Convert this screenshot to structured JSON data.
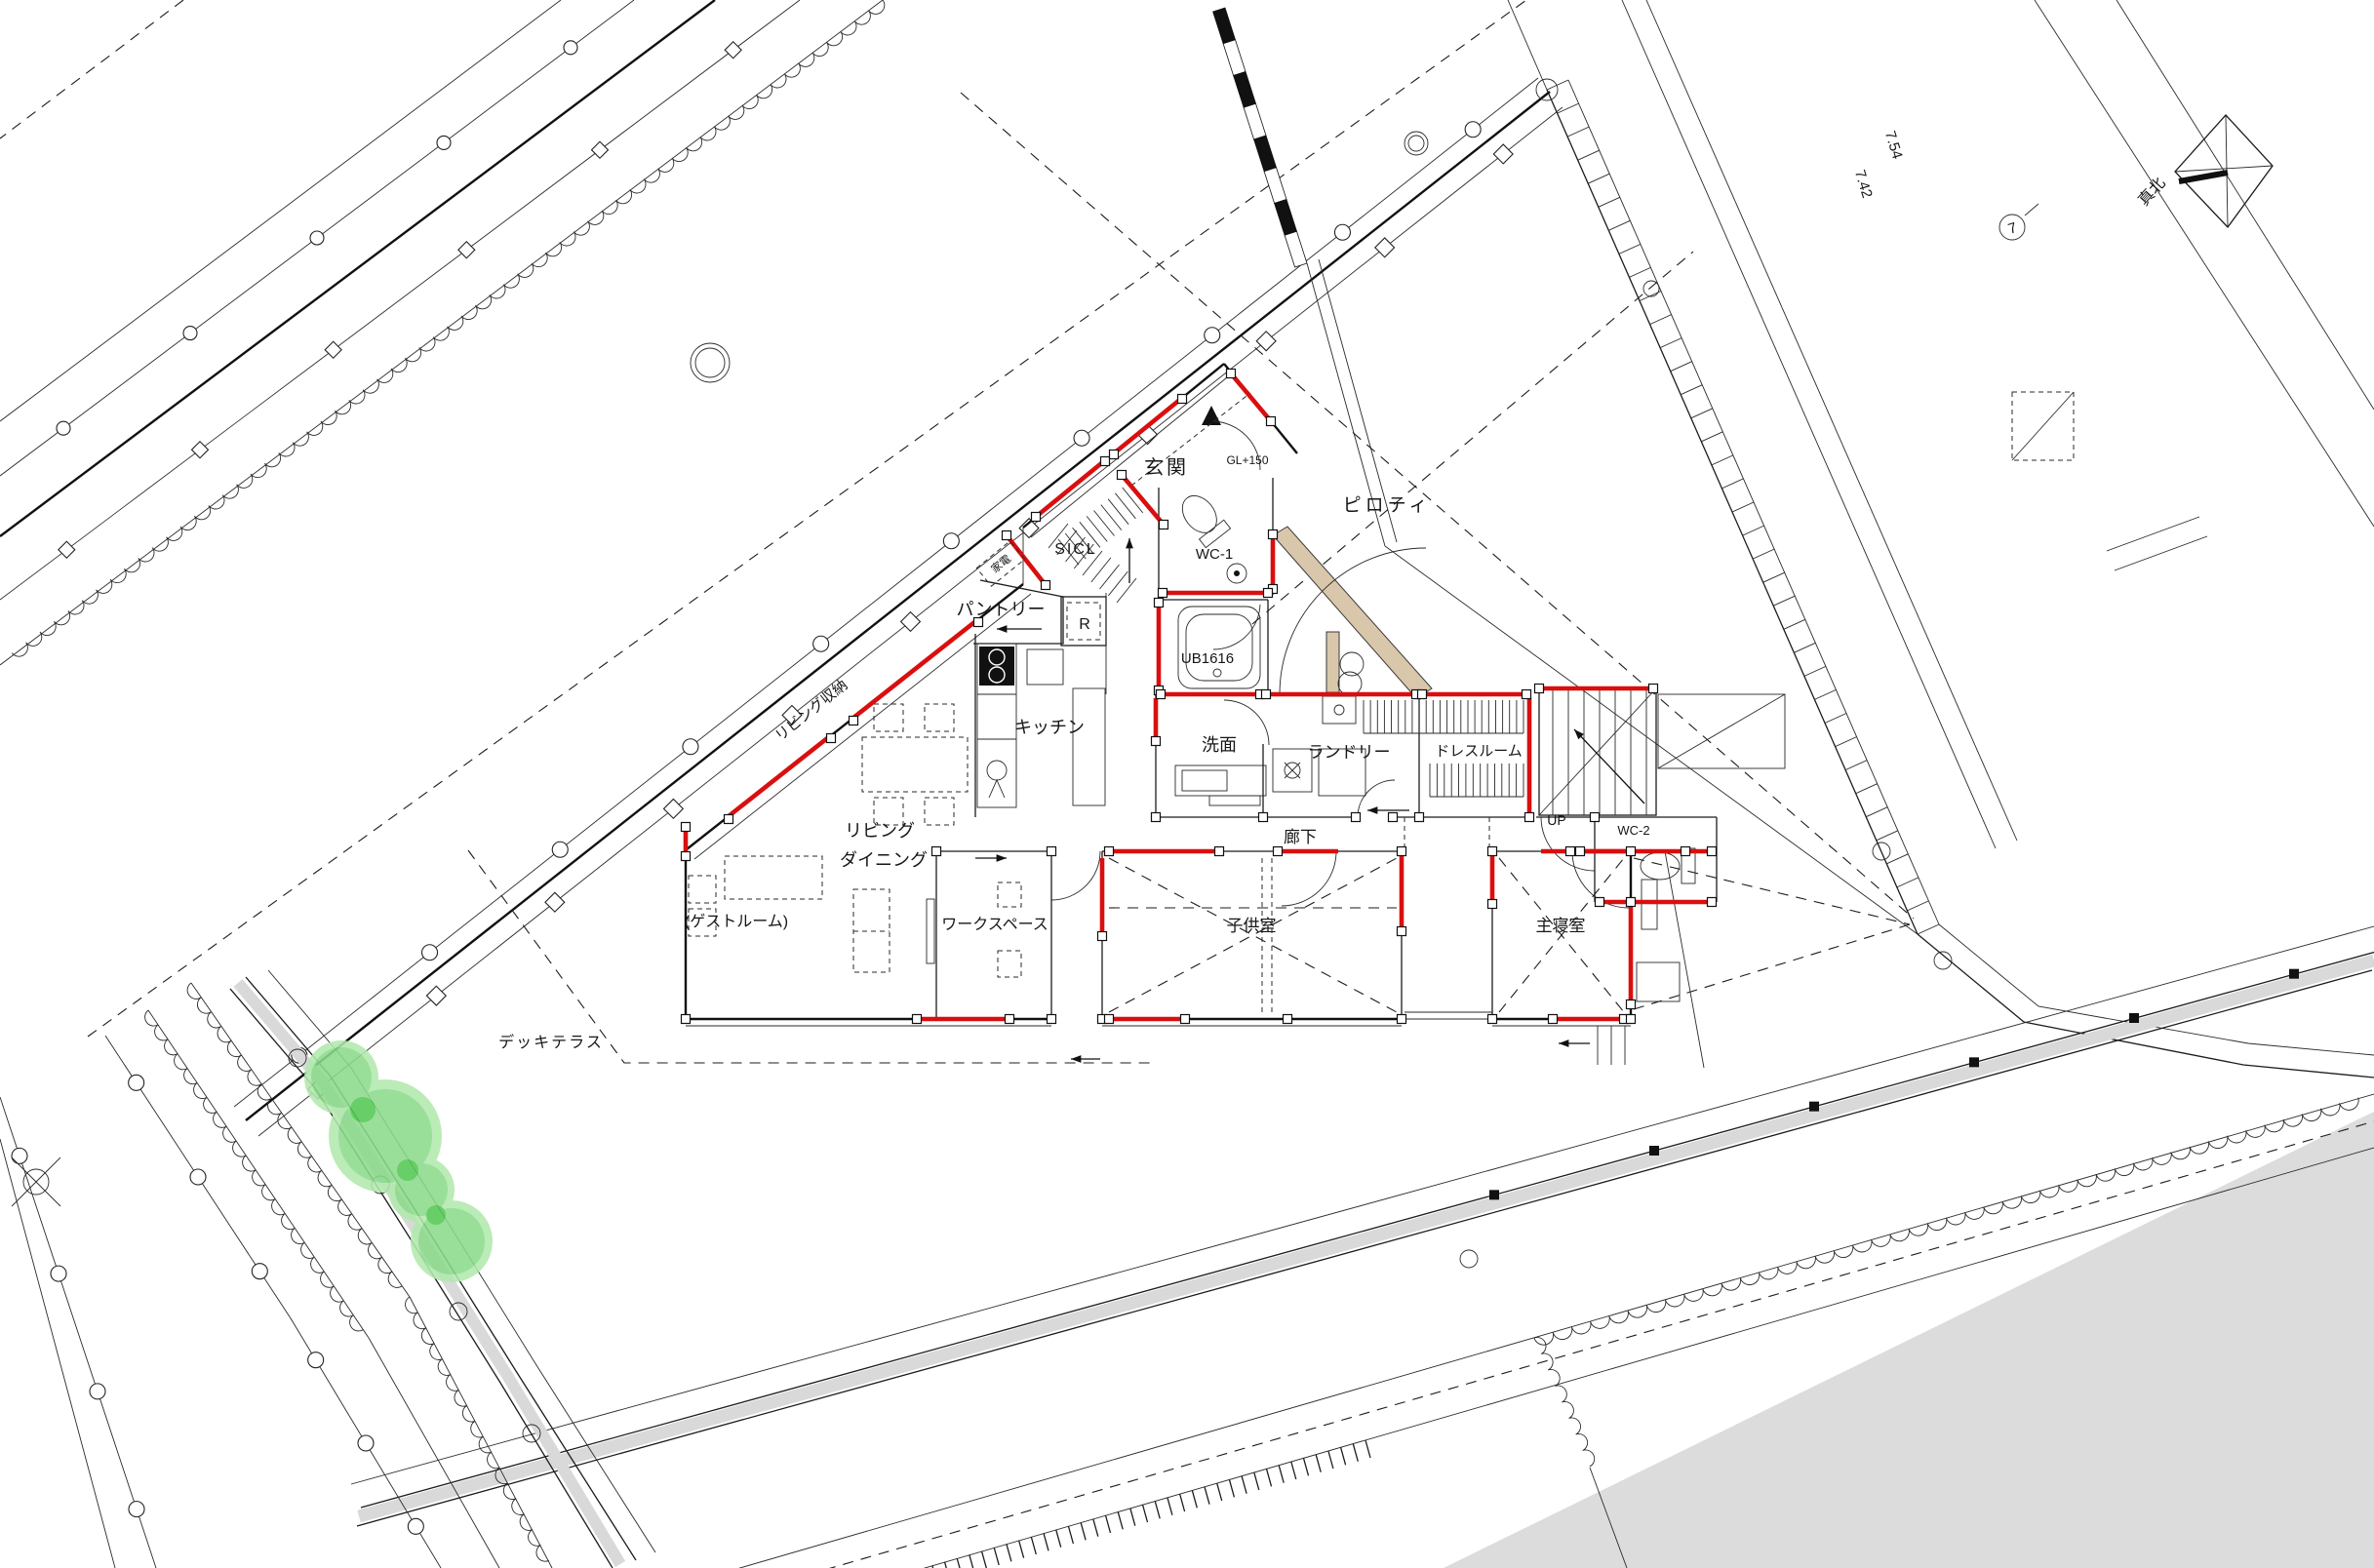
{
  "drawing": {
    "rooms": {
      "genkan": "玄関",
      "sicl": "SICL",
      "wc1": "WC-1",
      "ub": "UB1616",
      "pantry": "パントリー",
      "kaden": "家電",
      "fridge": "R",
      "kitchen": "キッチン",
      "senmen": "洗面",
      "laundry": "ランドリー",
      "dressroom": "ドレスルーム",
      "living_storage": "リビング収納",
      "living": "リビング",
      "dining": "ダイニング",
      "corridor": "廊下",
      "up": "UP",
      "wc2": "WC-2",
      "guestroom": "(ゲストルーム)",
      "workspace": "ワークスペース",
      "kidsroom": "子供室",
      "master_bedroom": "主寝室",
      "piloti": "ピロティ",
      "deck_terrace": "デッキテラス"
    },
    "annotations": {
      "gl_level": "GL+150",
      "true_north": "真北",
      "dim_742": "7.42",
      "dim_754": "7.54",
      "survey_point_7": "7"
    },
    "colors": {
      "wall_accent": "#d90f0f",
      "tree_fill": "#8bdb8b",
      "tree_light": "#b2e9ae",
      "tree_dark": "#54c854",
      "beam_tan": "#d9c7ab",
      "area_gray": "#dcdcdc"
    }
  }
}
